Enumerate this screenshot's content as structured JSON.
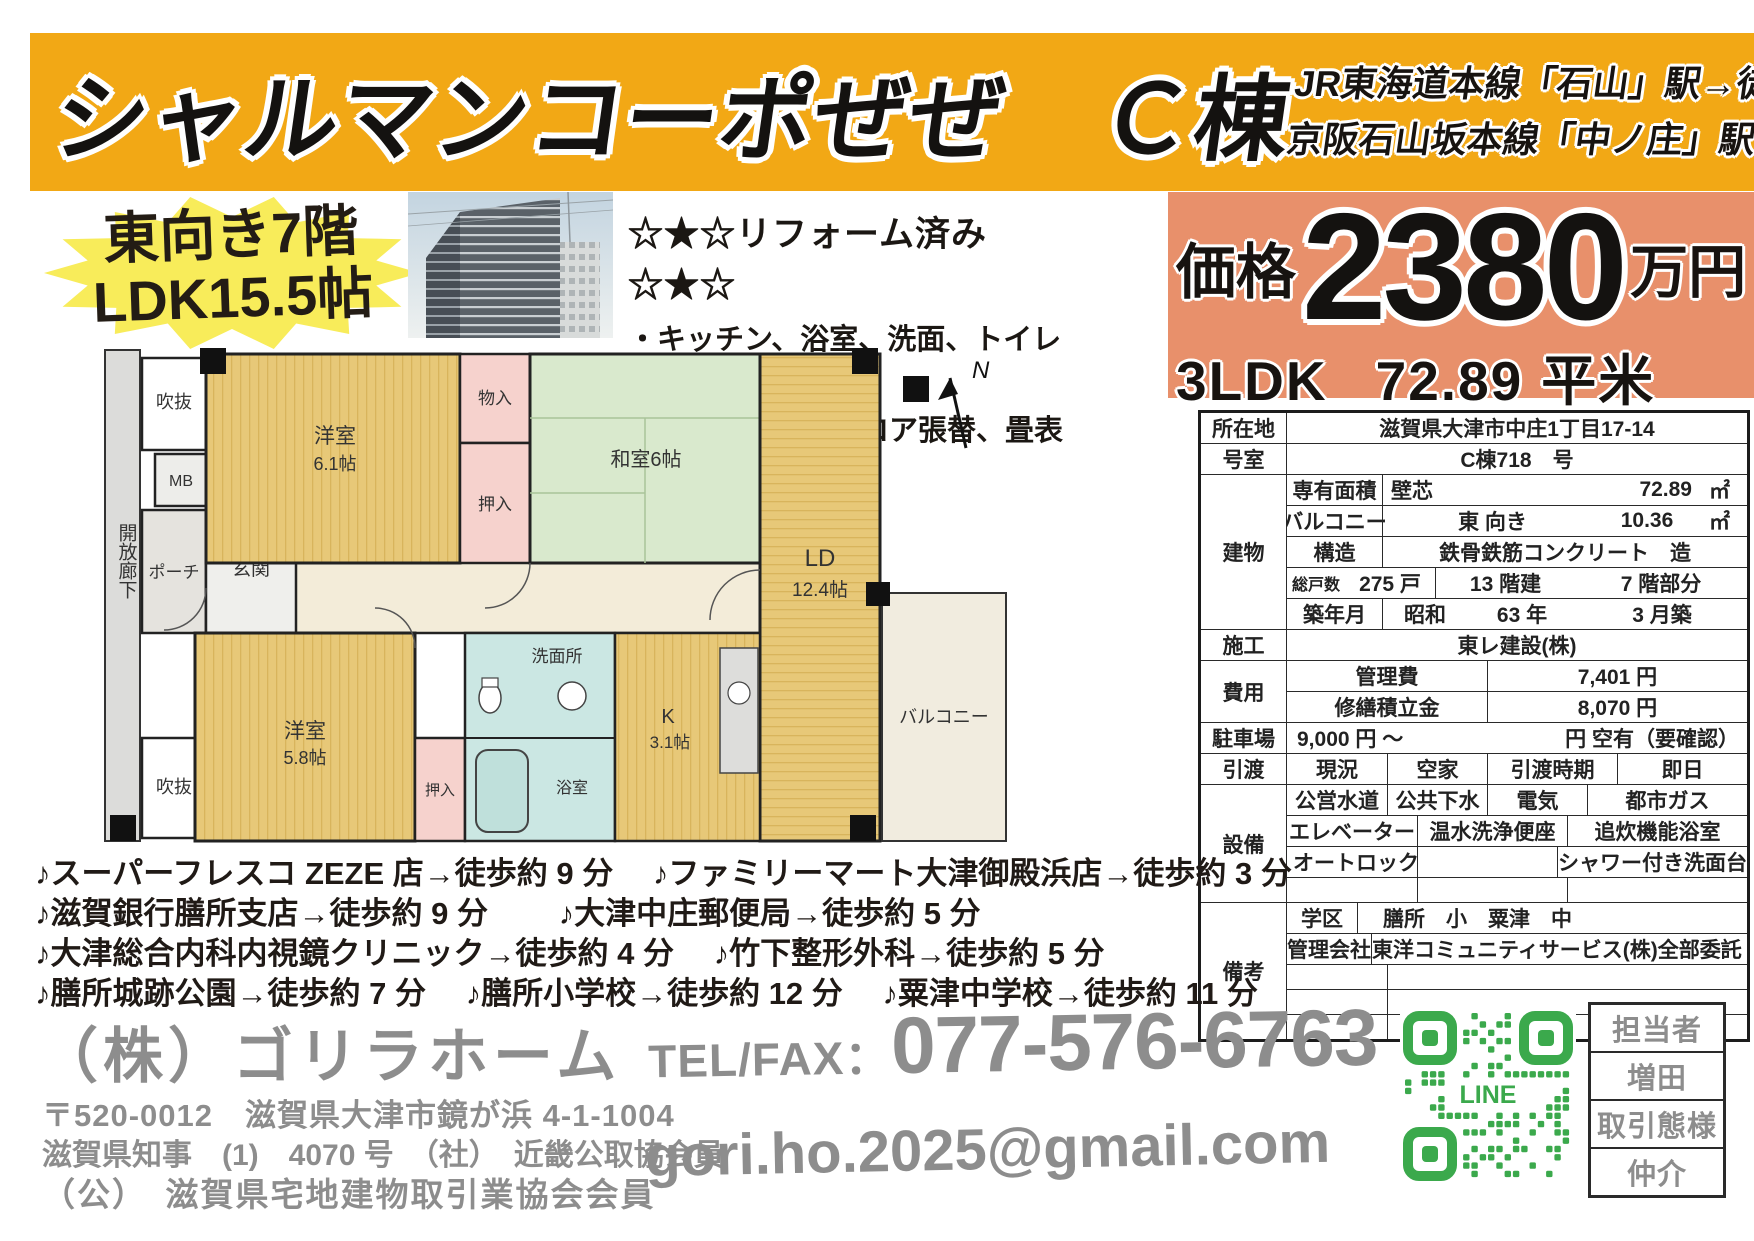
{
  "header": {
    "title": "シャルマンコーポぜぜ　Ｃ棟",
    "access1": "JR東海道本線「石山」駅→徒歩19分",
    "access2": "京阪石山坂本線「中ノ庄」駅→徒歩5分"
  },
  "badge": {
    "line1": "東向き7階",
    "line2": "LDK15.5帖"
  },
  "reform": {
    "title": "☆★☆リフォーム済み☆★☆",
    "item1": "・キッチン、浴室、洗面、トイレ➡新調",
    "item2": "・クロス張替、フロア張替、畳表替え"
  },
  "price": {
    "label": "価格",
    "amount": "2380",
    "unit": "万円",
    "layout": "3LDK",
    "area": "72.89",
    "area_unit": "平米"
  },
  "colors": {
    "banner": "#F2A815",
    "price_bg": "#E8906B",
    "qr_green": "#3BA94C"
  },
  "floorplan": {
    "north": "N",
    "corridor": "開放廊下",
    "fukinuke_top": "吹抜",
    "fukinuke_bottom": "吹抜",
    "mb": "MB",
    "porch": "ポーチ",
    "genkan": "玄関",
    "western1_name": "洋室",
    "western1_size": "6.1帖",
    "monoire": "物入",
    "oshiire_top": "押入",
    "washitsu": "和室6帖",
    "ld_name": "LD",
    "ld_size": "12.4帖",
    "western2_name": "洋室",
    "western2_size": "5.8帖",
    "oshiire_bottom": "押入",
    "senmenjo": "洗面所",
    "bath": "浴室",
    "kitchen_name": "K",
    "kitchen_size": "3.1帖",
    "balcony": "バルコニー"
  },
  "table": {
    "location_label": "所在地",
    "location_value": "滋賀県大津市中庄1丁目17-14",
    "room_label": "号室",
    "room_value": "C棟718　号",
    "building_label": "建物",
    "senyuu_label": "専有面積",
    "senyuu_type": "壁芯",
    "senyuu_value": "72.89",
    "senyuu_unit": "㎡",
    "balcony_label": "バルコニー",
    "balcony_dir": "東 向き",
    "balcony_value": "10.36",
    "balcony_unit": "㎡",
    "structure_label": "構造",
    "structure_value": "鉄骨鉄筋コンクリート　造",
    "units_label": "総戸数",
    "units_value": "275 戸",
    "floors_value": "13 階建",
    "floor_part": "7 階部分",
    "built_label": "築年月",
    "built_era": "昭和",
    "built_year": "63 年",
    "built_month": "3 月築",
    "construction_label": "施工",
    "construction_value": "東レ建設(株)",
    "cost_label": "費用",
    "mgmt_fee_label": "管理費",
    "mgmt_fee_value": "7,401 円",
    "repair_label": "修繕積立金",
    "repair_value": "8,070 円",
    "parking_label": "駐車場",
    "parking_value": "9,000 円 ～",
    "parking_note": "円 空有（要確認）",
    "handover_label": "引渡",
    "current_label": "現況",
    "current_value": "空家",
    "time_label": "引渡時期",
    "time_value": "即日",
    "facilities_label": "設備",
    "fac_r1c1": "公営水道",
    "fac_r1c2": "公共下水",
    "fac_r1c3": "電気",
    "fac_r1c4": "都市ガス",
    "fac_r2c1": "エレベーター",
    "fac_r2c2": "温水洗浄便座",
    "fac_r2c3": "追炊機能浴室",
    "fac_r3c1": "オートロック",
    "fac_r3c3": "シャワー付き洗面台",
    "remarks_label": "備考",
    "school_label": "学区",
    "school_value": "膳所　小　粟津　中",
    "mgmtco_label": "管理会社",
    "mgmtco_value": "東洋コミュニティサービス(株)",
    "mgmtco_note": "全部委託"
  },
  "amenities": {
    "line1": "♪スーパーフレスコ ZEZE 店→徒歩約 9 分　 ♪ファミリーマート大津御殿浜店→徒歩約 3 分",
    "line2": "♪滋賀銀行膳所支店→徒歩約 9 分　　 ♪大津中庄郵便局→徒歩約 5 分",
    "line3": "♪大津総合内科内視鏡クリニック→徒歩約 4 分　 ♪竹下整形外科→徒歩約 5 分",
    "line4": "♪膳所城跡公園→徒歩約 7 分　 ♪膳所小学校→徒歩約 12 分　 ♪粟津中学校→徒歩約 11 分"
  },
  "footer": {
    "company": "（株）ゴリラホーム",
    "address": "〒520-0012　滋賀県大津市鏡が浜 4-1-1004",
    "license": "滋賀県知事　(1)　4070 号　（社）　近畿公取協会員",
    "association": "（公）　滋賀県宅地建物取引業協会会員",
    "tel_label": "TEL/FAX：",
    "tel_number": "077-576-6763",
    "email": "gori.ho.2025@gmail.com",
    "line_label": "LINE",
    "staff_label": "担当者",
    "staff_name": "増田",
    "deal_label": "取引態様",
    "deal_type": "仲介"
  }
}
